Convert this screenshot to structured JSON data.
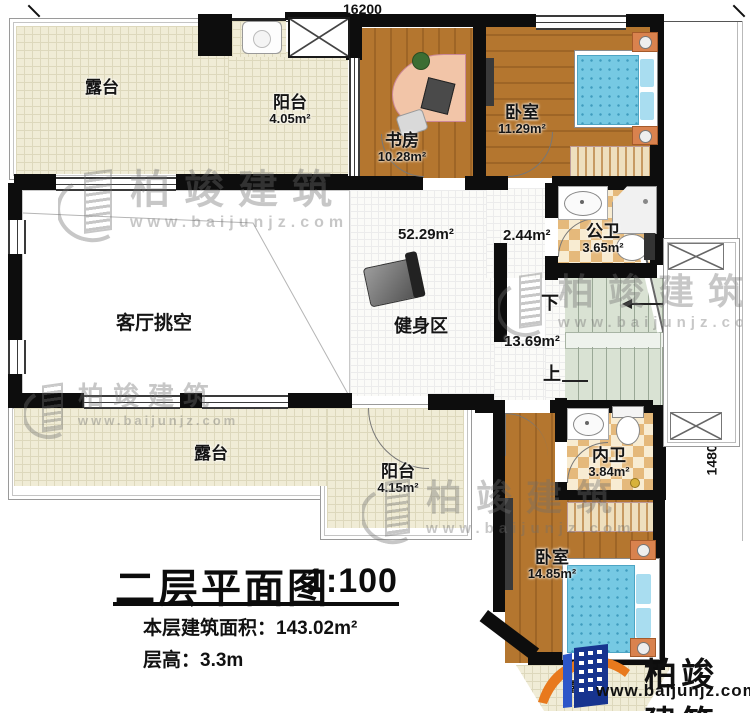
{
  "title_block": {
    "title": "二层平面图",
    "scale": "1:100",
    "area_label": "本层建筑面积：",
    "area_value": "143.02m²",
    "height_label": "层高：",
    "height_value": "3.3m"
  },
  "dimensions": {
    "top_width": "16200",
    "right_height": "14800"
  },
  "rooms": {
    "terrace_top": {
      "name": "露台"
    },
    "balcony_top": {
      "name": "阳台",
      "area": "4.05m²"
    },
    "study": {
      "name": "书房",
      "area": "10.28m²"
    },
    "bedroom1": {
      "name": "卧室",
      "area": "11.29m²"
    },
    "public_bath": {
      "name": "公卫",
      "area": "3.65m²"
    },
    "hall": {
      "area": "2.44m²"
    },
    "gym": {
      "name": "健身区",
      "area": "52.29m²"
    },
    "stair_hall": {
      "area": "13.69m²",
      "down": "下",
      "up": "上"
    },
    "living_void": {
      "name": "客厅挑空"
    },
    "terrace_bottom": {
      "name": "露台"
    },
    "balcony_bottom": {
      "name": "阳台",
      "area": "4.15m²"
    },
    "private_bath": {
      "name": "内卫",
      "area": "3.84m²"
    },
    "bedroom2": {
      "name": "卧室",
      "area": "14.85m²"
    },
    "terrace_small": {
      "name": "露台"
    }
  },
  "brand": {
    "name": "柏竣建筑",
    "suffix": "、",
    "url": "www.baijunjz.com"
  },
  "watermark": {
    "name": "柏竣建筑",
    "url": "www.baijunjz.com"
  },
  "colors": {
    "wall": "#0d0d0d",
    "wood": "#b4762f",
    "cream": "#f0ecd6",
    "checker": "#e5b97b",
    "stair_green": "#d9e2d3",
    "bed_blue": "#76c9e3",
    "logo_blue": "#17348f",
    "logo_orange": "#e8791d"
  }
}
